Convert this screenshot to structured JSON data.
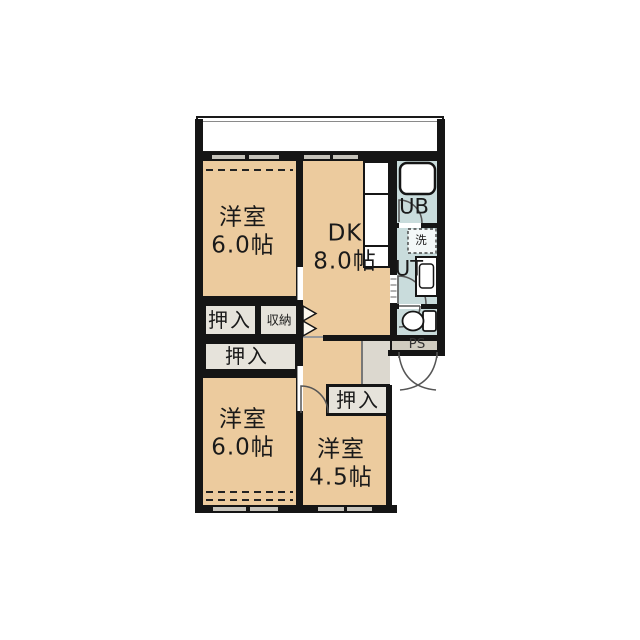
{
  "floorplan": {
    "rooms": [
      {
        "name": "洋室",
        "size": "6.0帖"
      },
      {
        "name": "DK",
        "size": "8.0帖"
      },
      {
        "name": "洋室",
        "size": "6.0帖"
      },
      {
        "name": "洋室",
        "size": "4.5帖"
      }
    ],
    "closets": [
      {
        "label": "押入"
      },
      {
        "label": "収納"
      },
      {
        "label": "押入"
      },
      {
        "label": "押入"
      }
    ],
    "labels": {
      "unit_bath": "UB",
      "utility": "UT",
      "pipe_space": "PS",
      "washer": "洗"
    },
    "colors": {
      "room_floor": "#eccb9e",
      "closet_floor": "#e6e3db",
      "wet_area_floor": "#c9dcdc",
      "hall_floor": "#dcd8cf",
      "wall": "#151515",
      "outside": "#ffffff"
    }
  }
}
